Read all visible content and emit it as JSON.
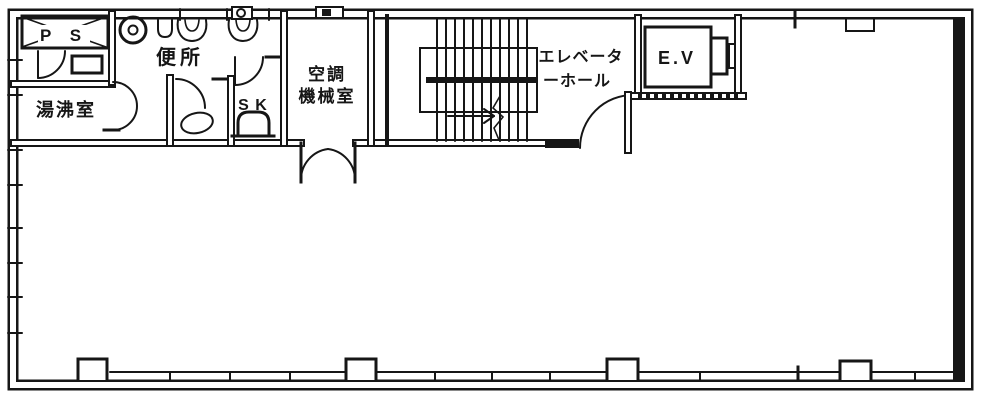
{
  "drawing": {
    "type": "architectural-floor-plan",
    "ink_color": "#161616",
    "background_color": "#ffffff"
  },
  "rooms": {
    "ps": {
      "label": "P S"
    },
    "hot_water_room": {
      "label": "湯沸室"
    },
    "toilet": {
      "label": "便所"
    },
    "slop_sink": {
      "label": "S K"
    },
    "ac_machine_room": {
      "line1": "空調",
      "line2": "機械室"
    },
    "elevator_hall": {
      "line1": "エレベータ",
      "line2": "ーホール"
    },
    "elevator": {
      "label": "E.V"
    }
  }
}
